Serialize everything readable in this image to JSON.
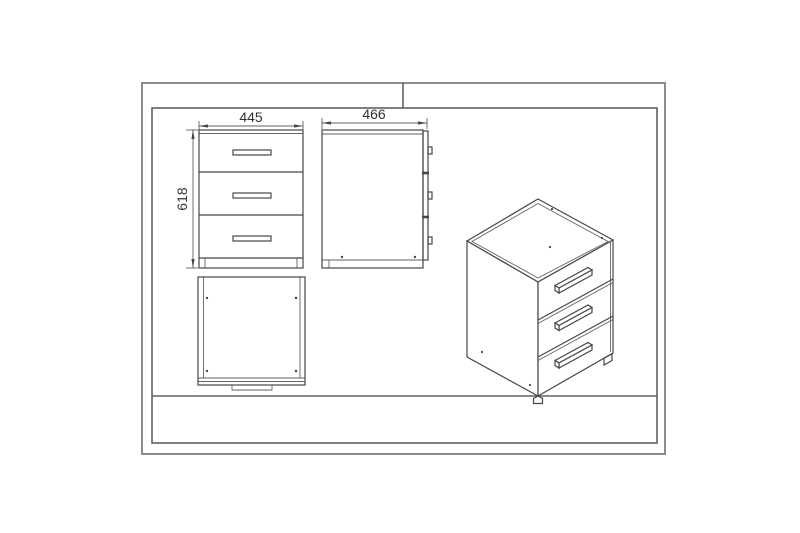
{
  "colors": {
    "bg": "#ffffff",
    "frame": "#8c8c8c",
    "frame-dark": "#606060",
    "line": "#474747",
    "text": "#333333"
  },
  "diagram": {
    "type": "furniture-technical-drawing",
    "subject": "three-drawer-cabinet",
    "dimensions": {
      "width": "445",
      "depth": "466",
      "height": "618"
    },
    "views": [
      {
        "id": "front-view",
        "drawers": 3,
        "labels": [
          "445",
          "618"
        ]
      },
      {
        "id": "side-view",
        "drawers": 3,
        "labels": [
          "466"
        ]
      },
      {
        "id": "top-view",
        "labels": []
      },
      {
        "id": "perspective-view",
        "drawers": 3,
        "labels": []
      }
    ]
  }
}
